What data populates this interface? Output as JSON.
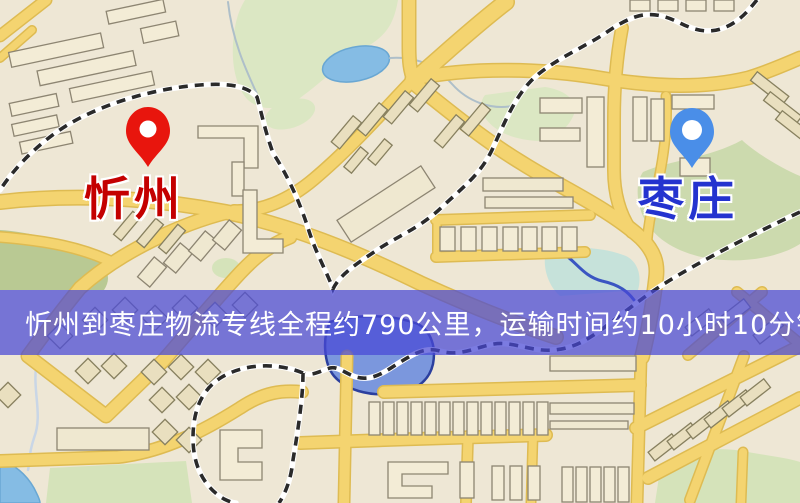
{
  "map": {
    "origin": {
      "name": "忻州",
      "pin_color": "#e8150d",
      "label_color": "#c40000"
    },
    "destination": {
      "name": "枣庄",
      "pin_color": "#4a8ee8",
      "label_color": "#2433cf"
    },
    "route_banner": {
      "text": "忻州到枣庄物流专线全程约790公里，运输时间约10小时10分钟.",
      "distance_km": 790,
      "duration": "10小时10分钟",
      "background_color": "#4848d5",
      "text_color": "#ffffff"
    },
    "palette": {
      "land": "#eee7d5",
      "road_yellow": "#f4d470",
      "park_green": "#dbe7c3",
      "water_blue": "#85bce4",
      "railway_black": "#2a2a2a",
      "building_cream": "#f3ecd6"
    }
  }
}
